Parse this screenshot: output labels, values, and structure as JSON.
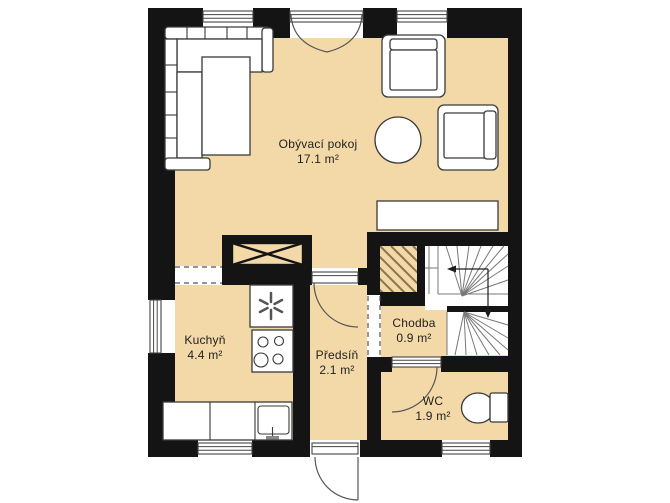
{
  "plan": {
    "type": "floor-plan",
    "rooms": [
      {
        "id": "living",
        "name": "Obývací pokoj",
        "area": "17.1 m²"
      },
      {
        "id": "kitchen",
        "name": "Kuchyň",
        "area": "4.4 m²"
      },
      {
        "id": "hall",
        "name": "Předsíň",
        "area": "2.1 m²"
      },
      {
        "id": "corridor",
        "name": "Chodba",
        "area": "0.9 m²"
      },
      {
        "id": "wc",
        "name": "WC",
        "area": "1.9 m²"
      }
    ],
    "icons": {
      "heater_fan": "✳",
      "stair_arrow_up": "◀",
      "stair_arrow_down": "▼"
    },
    "colors": {
      "floor": "#f3d8a8",
      "wall": "#141414",
      "hatch": "#8a7450",
      "furn": "#3a3a3a",
      "text": "#1f1f1f",
      "bg": "#ffffff"
    }
  }
}
